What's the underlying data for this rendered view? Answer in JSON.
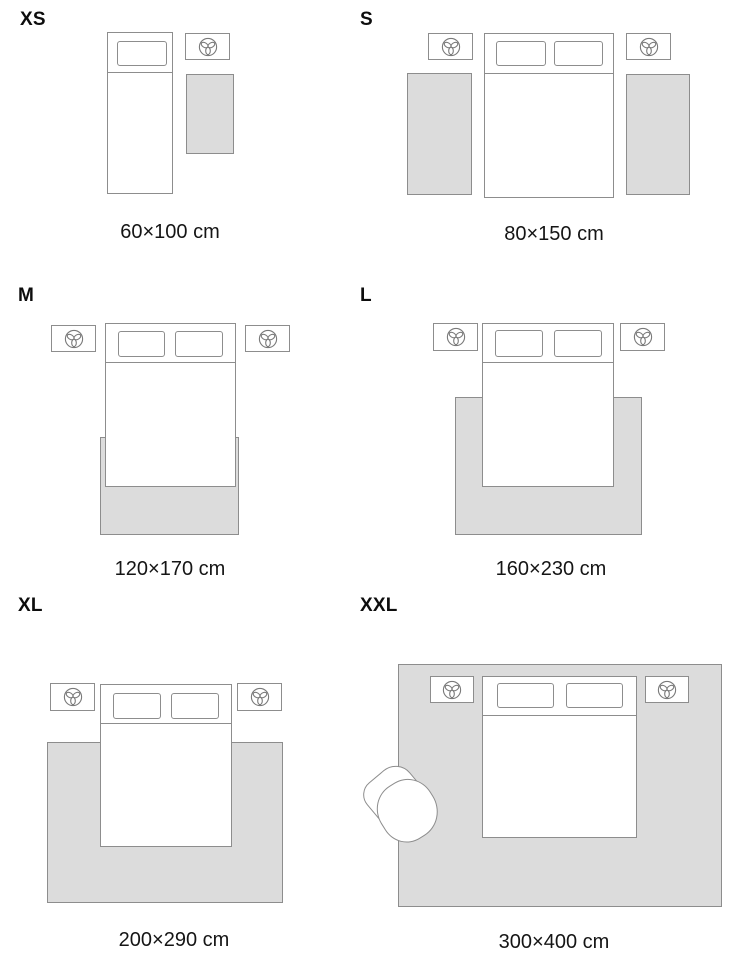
{
  "guide": {
    "title": "rug size guide bedroom layouts",
    "panels": [
      {
        "label": "XS",
        "caption": "60×100 cm",
        "layout": "single bed, one nightstand, one bedside rug"
      },
      {
        "label": "S",
        "caption": "80×150 cm",
        "layout": "double bed, two nightstands, two bedside runners"
      },
      {
        "label": "M",
        "caption": "120×170 cm",
        "layout": "double bed, two nightstands, rug under foot of bed"
      },
      {
        "label": "L",
        "caption": "160×230 cm",
        "layout": "double bed, two nightstands, wider rug under lower half of bed"
      },
      {
        "label": "XL",
        "caption": "200×290 cm",
        "layout": "double bed, two nightstands, large rug under most of bed"
      },
      {
        "label": "XXL",
        "caption": "300×400 cm",
        "layout": "room-size rug under bed, nightstands and armchair"
      }
    ],
    "colors": {
      "background": "#ffffff",
      "rug_fill": "#dcdcdc",
      "outline": "#8d8d8d",
      "label_text": "#0d0d0d",
      "caption_text": "#151515"
    },
    "icons": {
      "nightstand": "plant-top-view-icon",
      "armchair": "armchair-top-view"
    }
  }
}
